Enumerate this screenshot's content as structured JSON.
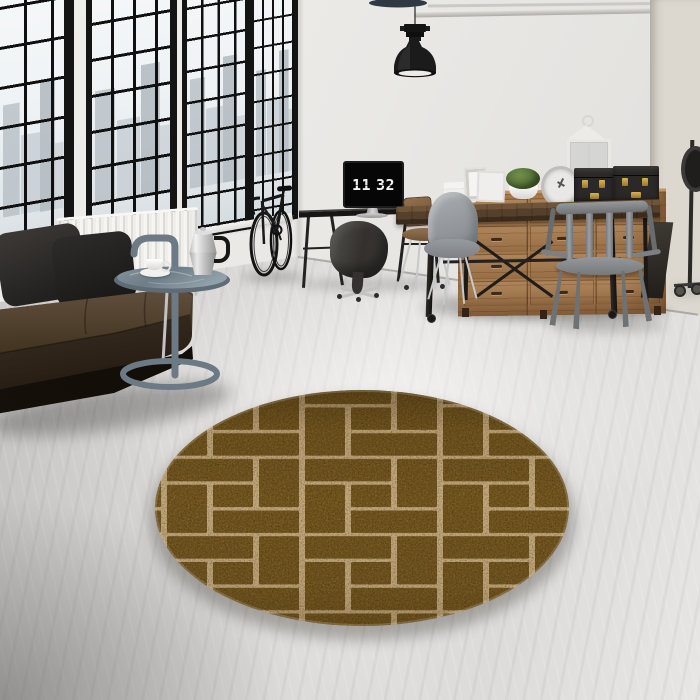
{
  "scene": {
    "type": "interior-product-photo",
    "room": "industrial loft living room",
    "product": "round brown brick-pattern area rug"
  },
  "monitor_clock": {
    "hours": "11",
    "minutes": "32"
  },
  "rug": {
    "shape": "round",
    "pattern": "brick-pinwheel",
    "tile_size": 138,
    "colors": {
      "brick": "#6f541f",
      "grout": "#c6ac82",
      "speck_gold": "#c99a40",
      "speck_dark": "#1f1508"
    },
    "bricks": [
      {
        "x": 3,
        "y": 3,
        "w": 86,
        "h": 40
      },
      {
        "x": 95,
        "y": 3,
        "w": 40,
        "h": 86
      },
      {
        "x": 3,
        "y": 49,
        "w": 40,
        "h": 86
      },
      {
        "x": 49,
        "y": 95,
        "w": 86,
        "h": 40
      },
      {
        "x": 49,
        "y": 49,
        "w": 40,
        "h": 40
      }
    ]
  },
  "palette": {
    "wall": "#e8e7e4",
    "wall_distressed": "#dcd7cf",
    "floor": "#dddcda",
    "window_frame": "#141414",
    "sofa_leather": "#3f3226",
    "side_table_metal": "#6e7e88",
    "sideboard_wood": "#a5794e",
    "table_wood": "#57422e",
    "metal_chair": "#85898b",
    "pendant_lamp": "#1c1c1c",
    "trunk_brass": "#c09a3e",
    "plant_green": "#5e7c3c"
  },
  "objects": [
    "factory-windows",
    "radiator",
    "leather-sofa",
    "pillows",
    "side-table",
    "moka-pot",
    "coffee-cup",
    "bicycle",
    "desk",
    "flip-clock-monitor",
    "office-chairs",
    "pendant-lamp",
    "wood-sideboard",
    "storage-trunks",
    "lantern",
    "moss-plant",
    "decor-clock",
    "dining-table",
    "metal-chairs",
    "rolling-lamp",
    "round-rug"
  ]
}
